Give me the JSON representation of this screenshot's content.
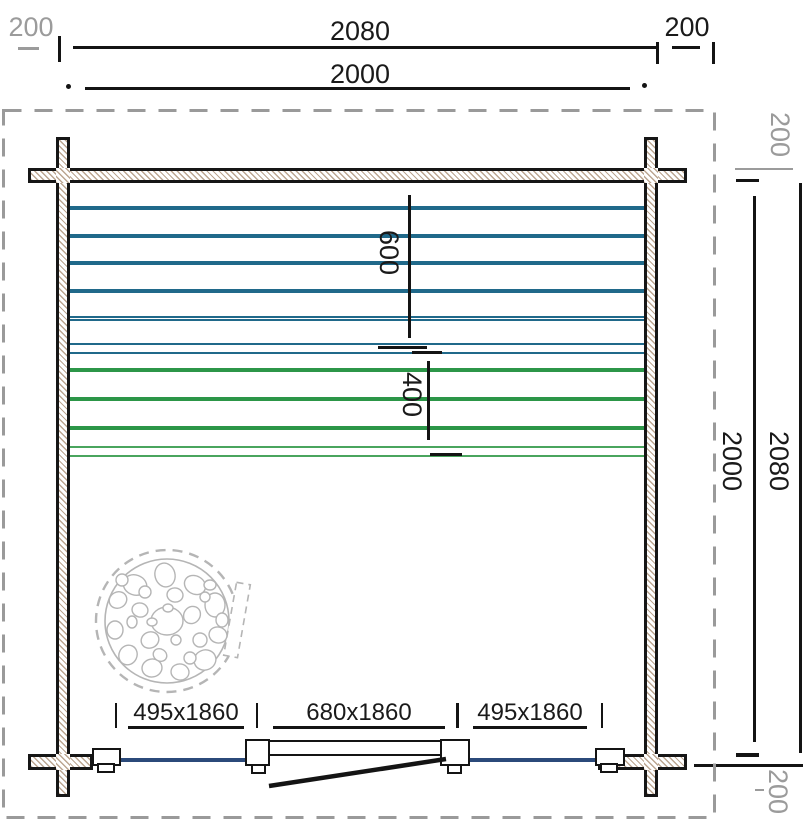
{
  "title": "Log cabin floor plan",
  "dimensions": {
    "top": {
      "overhang_left": "200",
      "outer_width": "2080",
      "inner_width": "2000",
      "overhang_right": "200"
    },
    "right": {
      "overhang_top": "200",
      "inner_height": "2000",
      "outer_height": "2080",
      "overhang_bottom": "200"
    },
    "interior": {
      "upper_bench_depth": "600",
      "lower_bench_depth": "400"
    },
    "openings": {
      "left_window": "495x1860",
      "door": "680x1860",
      "right_window": "495x1860"
    }
  },
  "colors": {
    "ink": "#1a1a1a",
    "gray_dim": "#9b9b9b",
    "bench_teal": "#20698a",
    "bench_green": "#2c9648",
    "bench_green_light": "#4aa55e",
    "window_glazing": "#2b4a7a",
    "wall_hatch": "#b0977e"
  }
}
